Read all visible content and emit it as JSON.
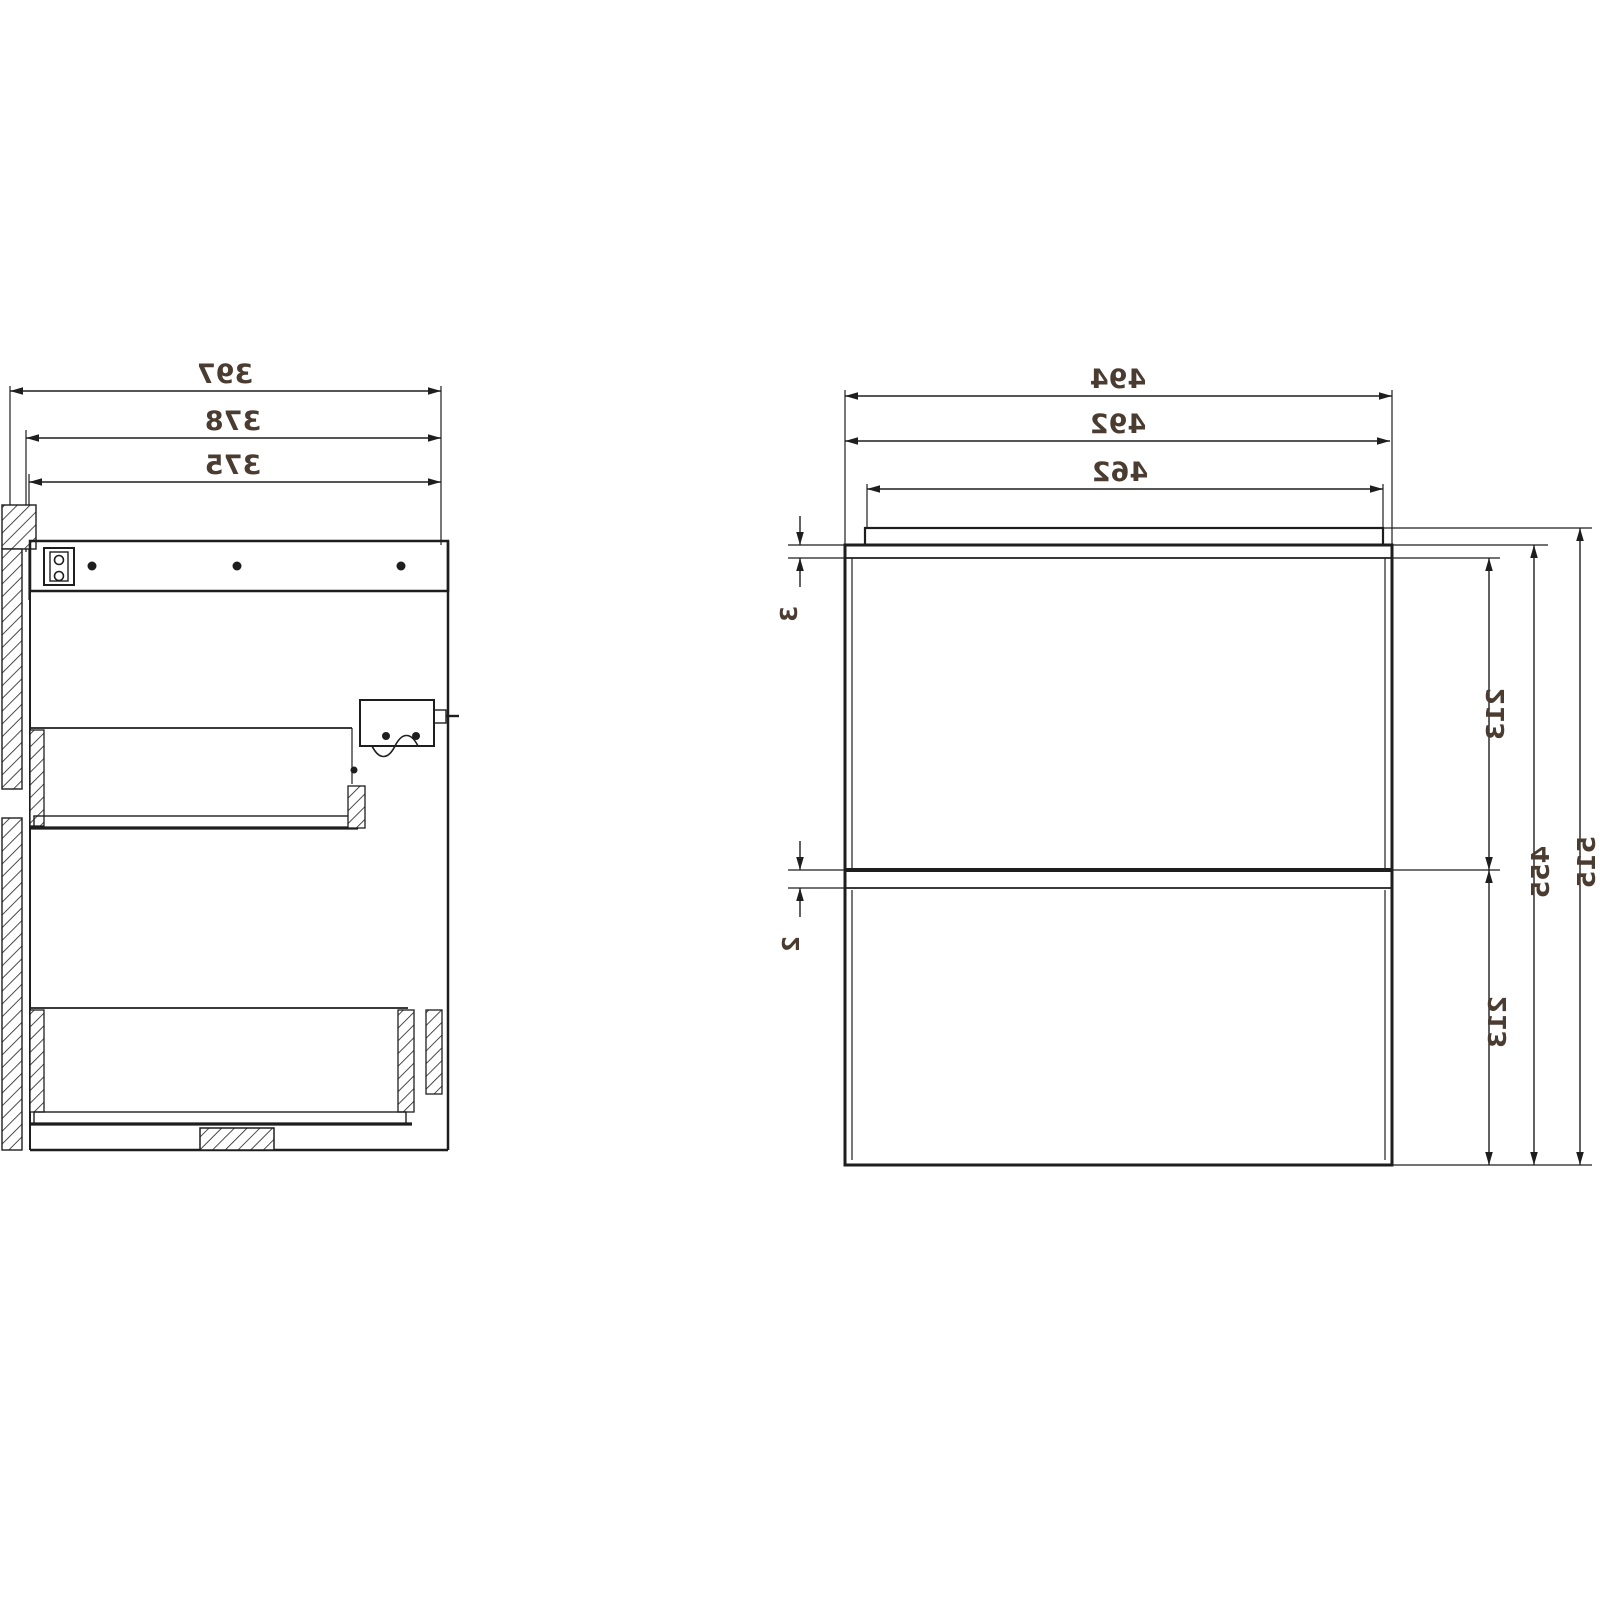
{
  "drawing": {
    "background": "#ffffff",
    "line_color": "#1e1e1e",
    "text_color": "#4a3c30",
    "side_view": {
      "dim_overall_depth": "397",
      "dim_body_depth": "378",
      "dim_inner_depth": "375"
    },
    "front_view": {
      "dim_overall_width": "494",
      "dim_carcass_width": "492",
      "dim_top_panel_width": "462",
      "dim_total_height": "515",
      "dim_carcass_height": "455",
      "dim_top_drawer_height": "213",
      "dim_bottom_drawer_height": "213",
      "dim_top_reveal": "3",
      "dim_drawer_gap": "2"
    }
  }
}
